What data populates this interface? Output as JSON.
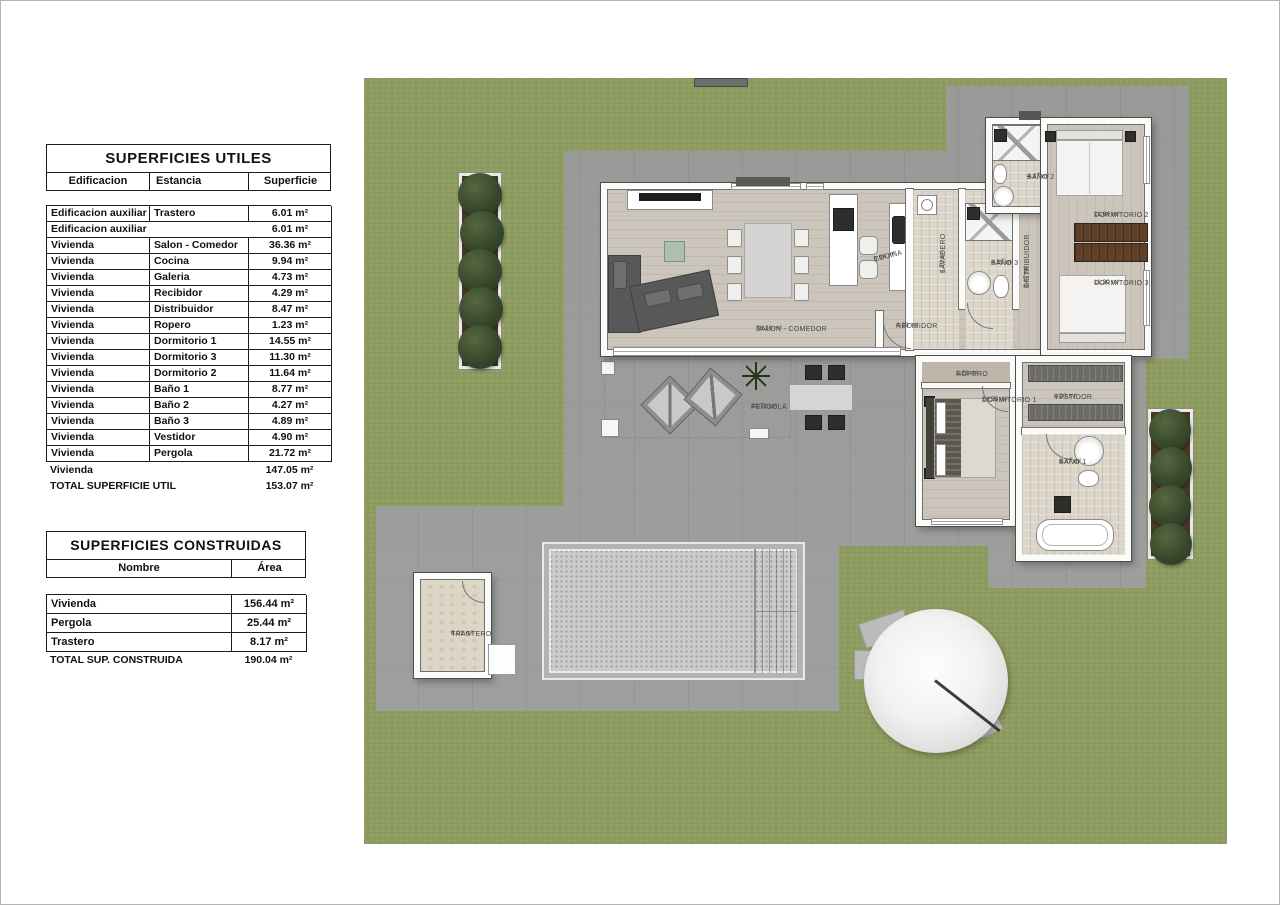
{
  "tables": {
    "utiles": {
      "title": "SUPERFICIES UTILES",
      "columns": [
        "Edificacion",
        "Estancia",
        "Superficie"
      ],
      "rows": [
        {
          "e": "Edificacion auxiliar",
          "s": "Trastero",
          "v": "6.01 m²"
        },
        {
          "e": "Edificacion auxiliar",
          "s": "",
          "v": "6.01 m²"
        },
        {
          "e": "Vivienda",
          "s": "Salon - Comedor",
          "v": "36.36 m²"
        },
        {
          "e": "Vivienda",
          "s": "Cocina",
          "v": "9.94 m²"
        },
        {
          "e": "Vivienda",
          "s": "Galeria",
          "v": "4.73 m²"
        },
        {
          "e": "Vivienda",
          "s": "Recibidor",
          "v": "4.29 m²"
        },
        {
          "e": "Vivienda",
          "s": "Distribuidor",
          "v": "8.47 m²"
        },
        {
          "e": "Vivienda",
          "s": "Ropero",
          "v": "1.23 m²"
        },
        {
          "e": "Vivienda",
          "s": "Dormitorio 1",
          "v": "14.55 m²"
        },
        {
          "e": "Vivienda",
          "s": "Dormitorio 3",
          "v": "11.30 m²"
        },
        {
          "e": "Vivienda",
          "s": "Dormitorio 2",
          "v": "11.64 m²"
        },
        {
          "e": "Vivienda",
          "s": "Baño 1",
          "v": "8.77 m²"
        },
        {
          "e": "Vivienda",
          "s": "Baño 2",
          "v": "4.27 m²"
        },
        {
          "e": "Vivienda",
          "s": "Baño 3",
          "v": "4.89 m²"
        },
        {
          "e": "Vivienda",
          "s": "Vestidor",
          "v": "4.90 m²"
        },
        {
          "e": "Vivienda",
          "s": "Pergola",
          "v": "21.72 m²"
        }
      ],
      "subtotal": {
        "label": "Vivienda",
        "value": "147.05 m²"
      },
      "total": {
        "label": "TOTAL SUPERFICIE UTIL",
        "value": "153.07 m²"
      }
    },
    "construidas": {
      "title": "SUPERFICIES CONSTRUIDAS",
      "columns": [
        "Nombre",
        "Área"
      ],
      "rows": [
        {
          "n": "Vivienda",
          "v": "156.44 m²"
        },
        {
          "n": "Pergola",
          "v": "25.44 m²"
        },
        {
          "n": "Trastero",
          "v": "8.17 m²"
        }
      ],
      "total": {
        "label": "TOTAL SUP. CONSTRUIDA",
        "value": "190.04 m²"
      }
    }
  },
  "plan": {
    "rooms": {
      "salon": {
        "name": "SALON - COMEDOR",
        "area": "36.36 m²"
      },
      "cocina": {
        "name": "COCINA",
        "area": "9.94 m²"
      },
      "recibidor": {
        "name": "RECIBIDOR",
        "area": "4.29 m²"
      },
      "lavadero": {
        "name": "LAVADERO",
        "area": "4.73 m²"
      },
      "bano3": {
        "name": "BAÑO 3",
        "area": "4.89 m²"
      },
      "distribuidor": {
        "name": "DISTRIBUIDOR",
        "area": "8.47 m²"
      },
      "bano2": {
        "name": "BAÑO 2",
        "area": "4.27 m²"
      },
      "dorm2": {
        "name": "DORMITORIO 2",
        "area": "11.64 m²"
      },
      "dorm3": {
        "name": "DORMITORIO 3",
        "area": "11.30 m²"
      },
      "ropero": {
        "name": "ROPERO",
        "area": "1.23 m²"
      },
      "dorm1": {
        "name": "DORMITORIO 1",
        "area": "14.55 m²"
      },
      "vestidor": {
        "name": "VESTIDOR",
        "area": "4.90 m²"
      },
      "bano1": {
        "name": "BAÑO 1",
        "area": "8.77 m²"
      },
      "pergola": {
        "name": "PERGOLA",
        "area": "21.72 m²"
      },
      "trastero": {
        "name": "TRASTERO",
        "area": "6.01 m²"
      }
    },
    "colors": {
      "lawn": "#8E9D5F",
      "pavement": "#9E9E9C",
      "floor_wood": "#CBC5BB",
      "wall": "#FBFBF9",
      "bush": "#36462A",
      "pool_gravel": "#CDCCCA",
      "wardrobe_wood": "#5F4129"
    }
  }
}
